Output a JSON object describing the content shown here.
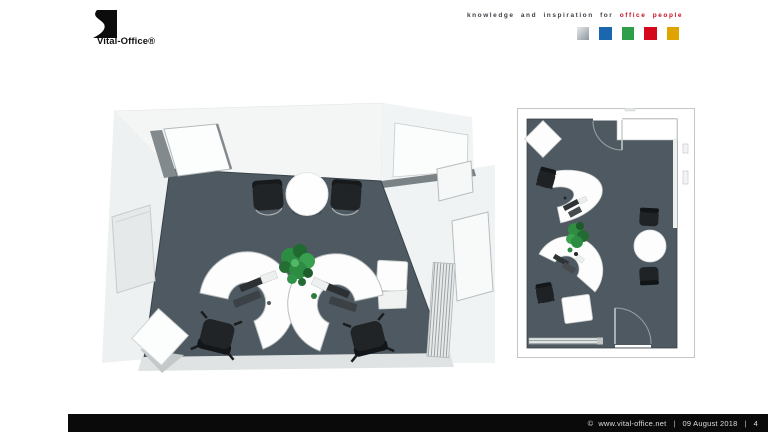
{
  "header": {
    "logo": {
      "text": "Vital-Office®"
    },
    "tagline": {
      "normal": "knowledge and inspiration for",
      "highlight": "office people",
      "highlight_color": "#c50e20"
    },
    "palette": [
      {
        "name": "silver-square",
        "color": "#c3c9cc",
        "gradient_from": "#e7eaec",
        "gradient_to": "#8d969c"
      },
      {
        "name": "blue-square",
        "color": "#1a67af"
      },
      {
        "name": "green-square",
        "color": "#2f9e4b"
      },
      {
        "name": "red-square",
        "color": "#d4071c"
      },
      {
        "name": "gold-square",
        "color": "#dfa400"
      }
    ]
  },
  "footer": {
    "copyright_symbol": "©",
    "site": "www.vital-office.net",
    "separator": "|",
    "date": "09 August 2018",
    "page_number": "4"
  },
  "scene": {
    "colors": {
      "floor": "#4e5961",
      "wall": "#eef1f1",
      "wall_light": "#f4f6f6",
      "desk": "#fdfdfd",
      "chair": "#202427",
      "plant": "#2c8c41",
      "edge": "#c8cccc"
    }
  }
}
